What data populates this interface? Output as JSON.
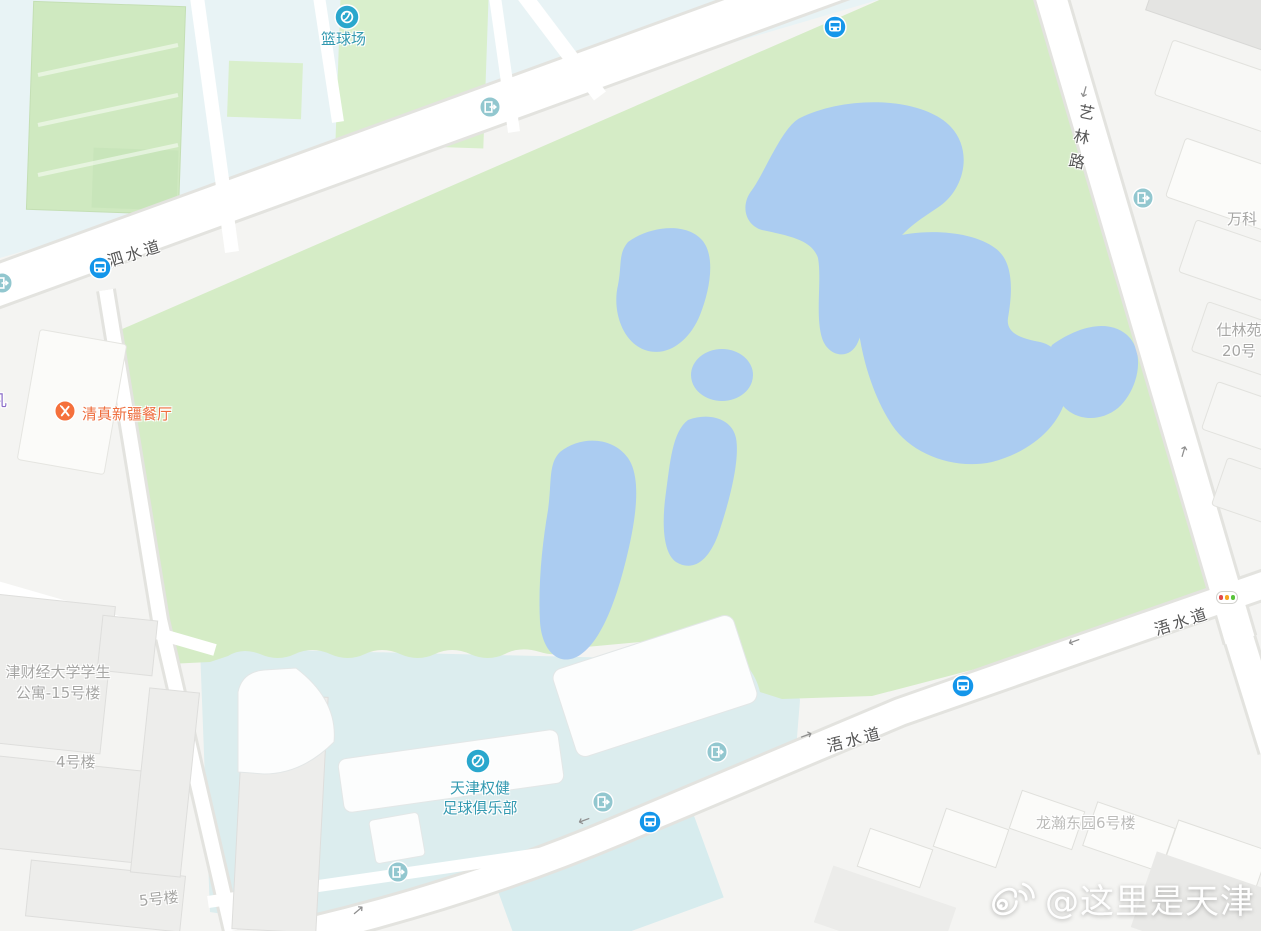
{
  "map": {
    "roads": {
      "sishui": "泗水道",
      "yilin": "艺林路",
      "wushui_east": "浯水道",
      "wushui_mid": "浯水道"
    },
    "pois": {
      "basketball_court": "篮球场",
      "halal_restaurant": "清真新疆餐厅",
      "football_club_line1": "天津权健",
      "football_club_line2": "足球俱乐部"
    },
    "buildings": {
      "vanke": "万科",
      "shilin_line1": "仕林苑",
      "shilin_line2": "20号",
      "dorm_line1": "津财经大学学生",
      "dorm_line2": "公寓-15号楼",
      "building4": "4号楼",
      "building5": "5号楼",
      "longhan": "龙瀚东园6号楼",
      "edge_partial": "凡"
    },
    "watermark": "@这里是天津",
    "glyphs": {
      "arrow_up": "↑",
      "arrow_down": "↓",
      "arrow_left": "←",
      "arrow_right": "→"
    },
    "icons": {
      "bus_stop": "bus-stop-icon",
      "entrance": "entrance-exit-icon",
      "sports": "sports-poi-icon",
      "restaurant": "restaurant-poi-icon",
      "traffic_light": "traffic-light-icon",
      "weibo": "weibo-logo-icon"
    },
    "colors": {
      "park_green": "#d5ecc6",
      "water_blue": "#abccf1",
      "campus_cyan": "#e8f3f5",
      "stadium_cyan": "#dcedee",
      "bus_blue": "#1496ea",
      "entrance_teal": "#92c7cf",
      "poi_teal": "#3299b0",
      "poi_orange": "#ee6e3e"
    }
  }
}
